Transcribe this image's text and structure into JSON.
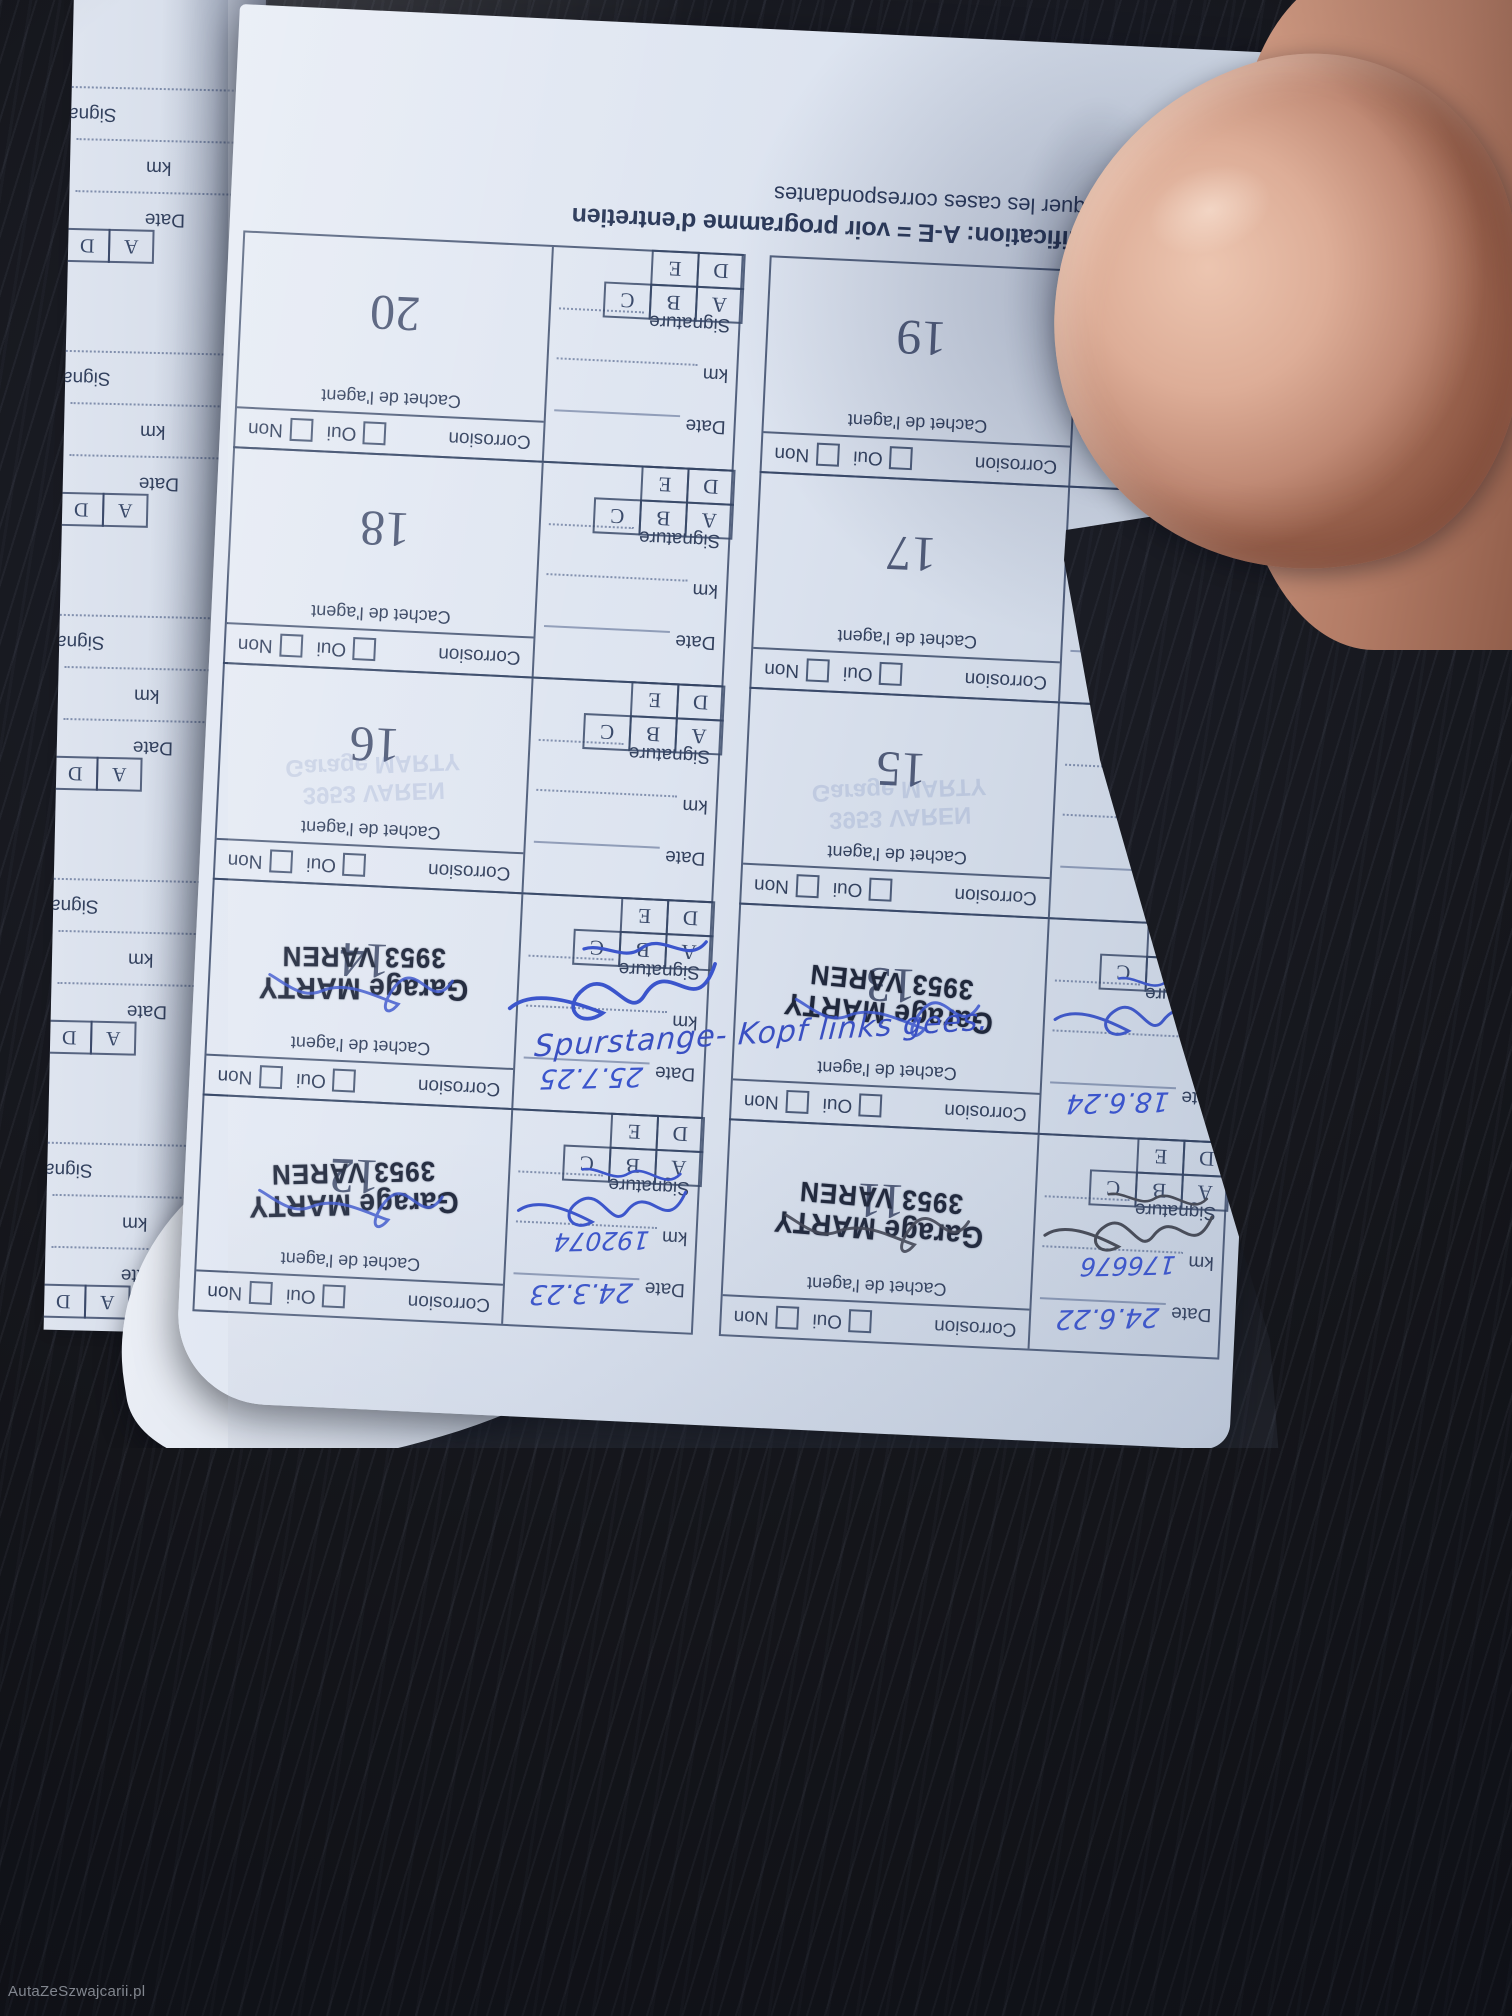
{
  "watermark": "AutaZeSzwajcarii.pl",
  "legend": {
    "line1_bold": "Signification: A-E = voir programme d'entretien",
    "line2": "Marquer les cases correspondantes"
  },
  "field_labels": {
    "date": "Date",
    "km": "km",
    "signature": "Signature",
    "cachet": "Cachet de l'agent",
    "corrosion": "Corrosion",
    "oui": "Oui",
    "non": "Non",
    "letters_row1": [
      "A",
      "B",
      "C"
    ],
    "letters_row2": [
      "D",
      "E"
    ]
  },
  "stamp": {
    "line1": "Garage MARTY",
    "line2": "3953 VAREN"
  },
  "note": {
    "text": "Spurstange- Kopf links gees."
  },
  "boxes": [
    {
      "number": "11",
      "stamped": true,
      "date": "24.6.22",
      "km": "176676",
      "signature_style": "dark",
      "cell_scribble": "dark",
      "ghost": false
    },
    {
      "number": "12",
      "stamped": true,
      "date": "24.3.23",
      "km": "192074",
      "signature_style": "blue",
      "cell_scribble": "blue",
      "ghost": false
    },
    {
      "number": "13",
      "stamped": true,
      "date": "18.6.24",
      "km": "",
      "signature_style": "blue-loops",
      "cell_scribble": "blue",
      "ghost": false
    },
    {
      "number": "14",
      "stamped": true,
      "date": "25.7.25",
      "km": "",
      "signature_style": "blue-large",
      "cell_scribble": "blue",
      "ghost": false
    },
    {
      "number": "15",
      "stamped": false,
      "date": "",
      "km": "",
      "signature_style": "none",
      "cell_scribble": "",
      "ghost": true
    },
    {
      "number": "16",
      "stamped": false,
      "date": "",
      "km": "",
      "signature_style": "none",
      "cell_scribble": "",
      "ghost": true
    },
    {
      "number": "17",
      "stamped": false,
      "date": "",
      "km": "",
      "signature_style": "none",
      "cell_scribble": "",
      "ghost": false
    },
    {
      "number": "18",
      "stamped": false,
      "date": "",
      "km": "",
      "signature_style": "none",
      "cell_scribble": "",
      "ghost": false
    },
    {
      "number": "19",
      "stamped": false,
      "date": "",
      "km": "",
      "signature_style": "none",
      "cell_scribble": "",
      "ghost": false
    },
    {
      "number": "20",
      "stamped": false,
      "date": "",
      "km": "",
      "signature_style": "none",
      "cell_scribble": "",
      "ghost": false
    }
  ],
  "side_strip": {
    "signature_label": "Signature",
    "km_label": "km",
    "date_label": "Date",
    "letters": [
      "A",
      "D"
    ]
  },
  "ink_colors": {
    "handwriting_blue": "#3b55cc",
    "handwriting_dark": "#474b57",
    "stamp_ink": "#20283c"
  }
}
